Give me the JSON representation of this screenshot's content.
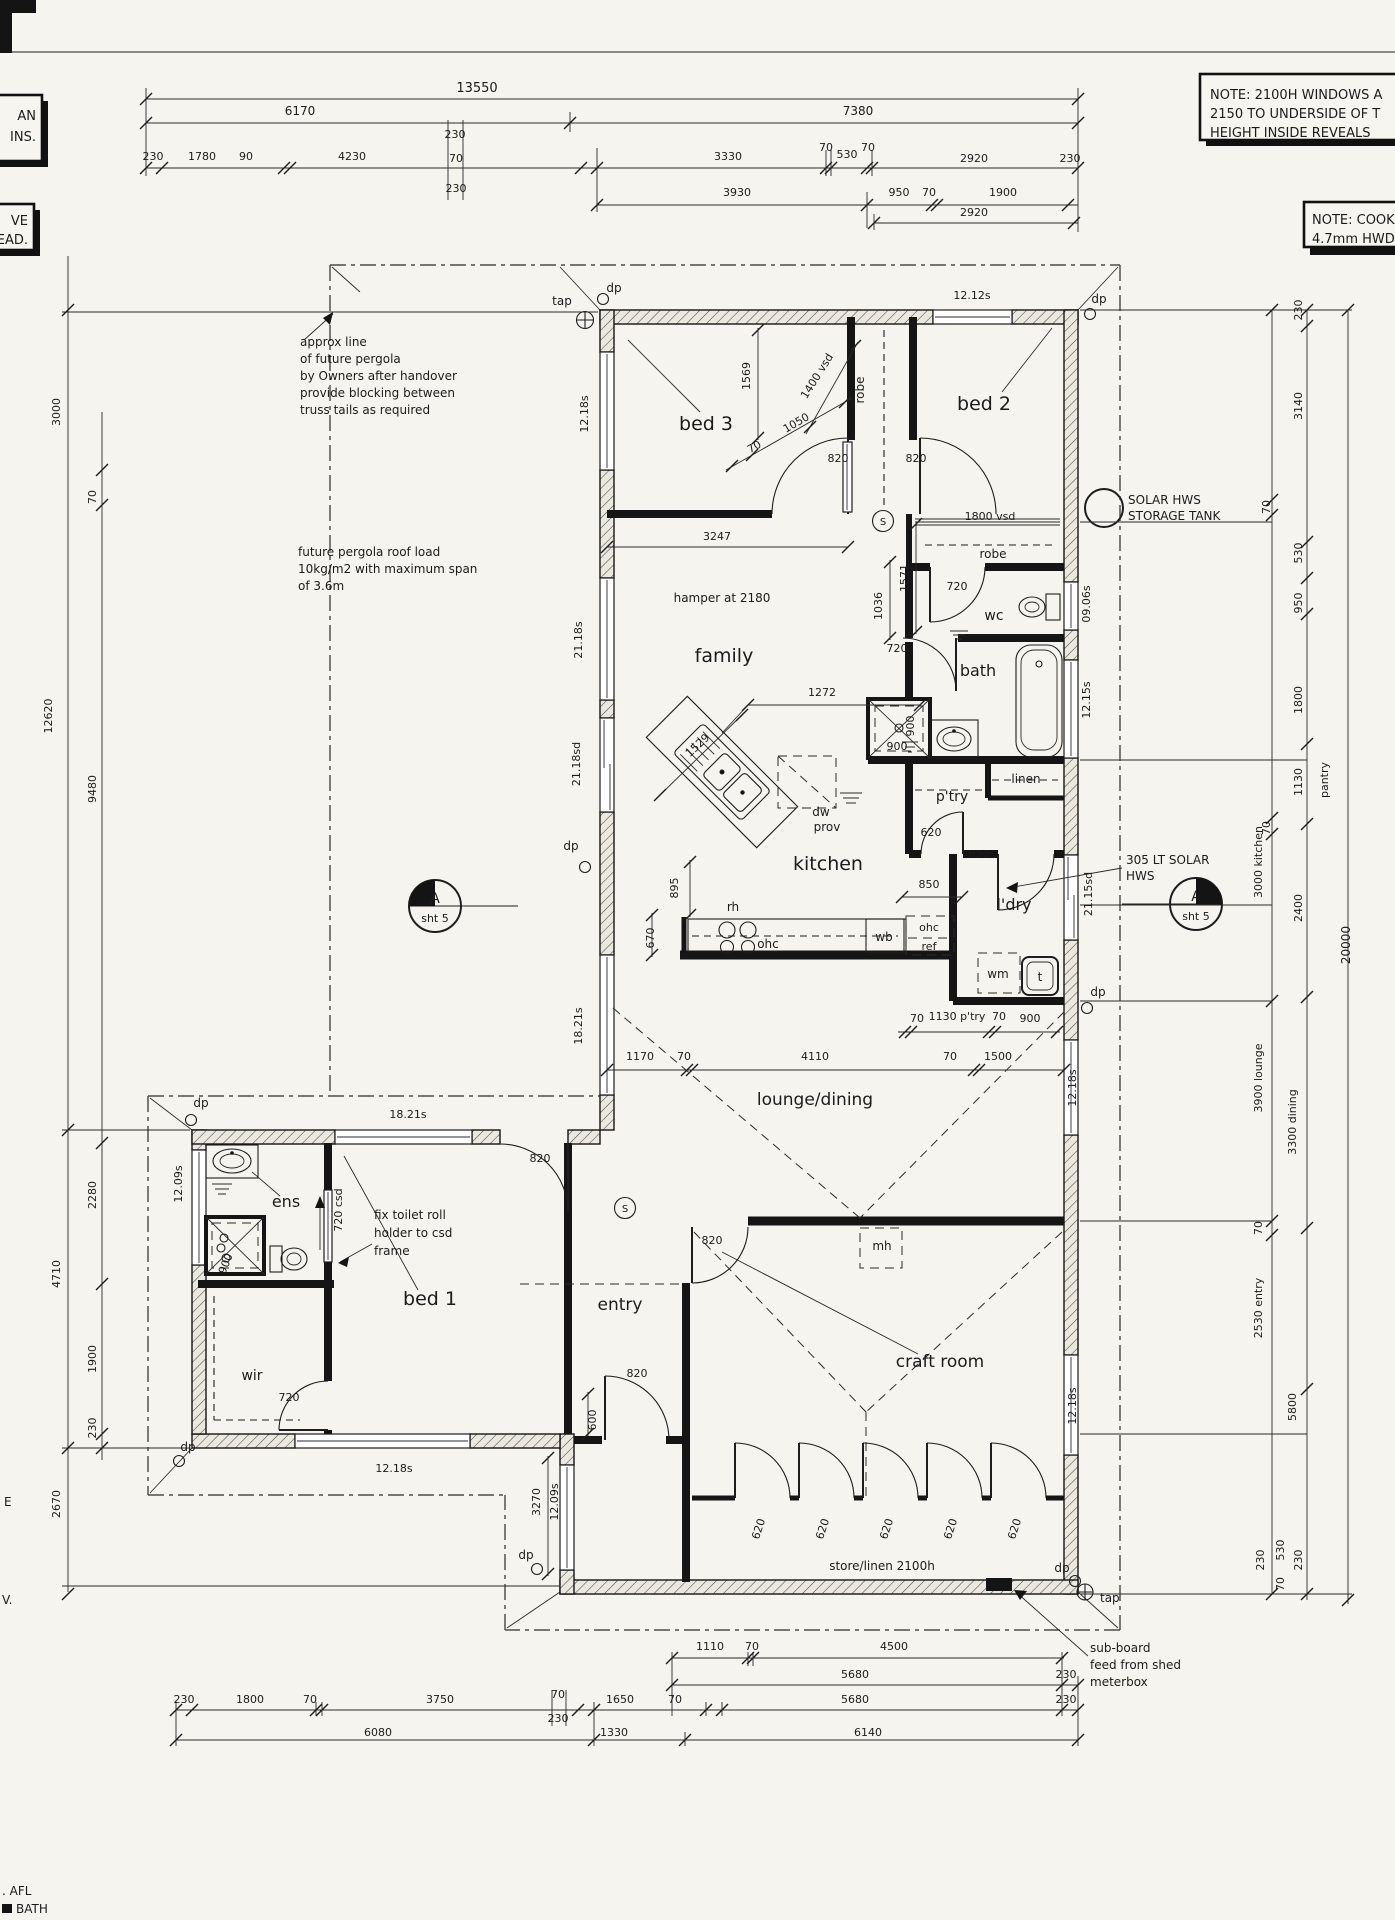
{
  "title": "house floor plan working drawing",
  "colors": {
    "paper": "#f6f4ee",
    "ink": "#1b1b1b",
    "hatch_bg": "#ece9e0"
  },
  "notes": {
    "left_a_line1": "AN",
    "left_a_line2": "INS.",
    "left_b_line1": "VE",
    "left_b_line2": "HEAD.",
    "windows_line1": "NOTE: 2100H WINDOWS A",
    "windows_line2": "2150 TO UNDERSIDE OF T",
    "windows_line3": "HEIGHT INSIDE REVEALS",
    "cook_line1": "NOTE: COOK",
    "cook_line2": "4.7mm HWD",
    "edge_e": "E",
    "edge_v": "V.",
    "edge_afl": ". AFL",
    "edge_bath": "BATH"
  },
  "labels": [
    [
      "13550",
      477,
      92,
      0,
      13
    ],
    [
      "6170",
      300,
      115,
      0,
      12
    ],
    [
      "7380",
      858,
      115,
      0,
      12
    ],
    [
      "230",
      153,
      160
    ],
    [
      "1780",
      202,
      160
    ],
    [
      "90",
      246,
      160
    ],
    [
      "4230",
      352,
      160
    ],
    [
      "230",
      455,
      138
    ],
    [
      "70",
      456,
      162
    ],
    [
      "230",
      456,
      192
    ],
    [
      "3330",
      728,
      160
    ],
    [
      "70",
      826,
      151
    ],
    [
      "530",
      847,
      158
    ],
    [
      "70",
      868,
      151
    ],
    [
      "2920",
      974,
      162
    ],
    [
      "230",
      1070,
      162
    ],
    [
      "3930",
      737,
      196
    ],
    [
      "950",
      899,
      196
    ],
    [
      "70",
      929,
      196
    ],
    [
      "1900",
      1003,
      196
    ],
    [
      "2920",
      974,
      216
    ],
    [
      "3000",
      60,
      412,
      -90
    ],
    [
      "70",
      96,
      497,
      -90
    ],
    [
      "12620",
      52,
      716,
      -90
    ],
    [
      "9480",
      96,
      789,
      -90
    ],
    [
      "2280",
      96,
      1195,
      -90
    ],
    [
      "4710",
      60,
      1274,
      -90
    ],
    [
      "1900",
      96,
      1359,
      -90
    ],
    [
      "230",
      96,
      1428,
      -90
    ],
    [
      "2670",
      60,
      1504,
      -90
    ],
    [
      "230",
      1302,
      310,
      -90
    ],
    [
      "3140",
      1302,
      406,
      -90
    ],
    [
      "70",
      1270,
      507,
      -90
    ],
    [
      "530",
      1302,
      553,
      -90
    ],
    [
      "950",
      1302,
      603,
      -90
    ],
    [
      "1800",
      1302,
      700,
      -90
    ],
    [
      "1130",
      1302,
      782,
      -90
    ],
    [
      "pantry",
      1328,
      780,
      -90
    ],
    [
      "70",
      1270,
      828,
      -90
    ],
    [
      "2400",
      1302,
      908,
      -90
    ],
    [
      "20000",
      1350,
      945,
      -90,
      12
    ],
    [
      "3000 kitchen",
      1262,
      862,
      -90
    ],
    [
      "3900 lounge",
      1262,
      1078,
      -90
    ],
    [
      "3300 dining",
      1296,
      1122,
      -90
    ],
    [
      "70",
      1262,
      1228,
      -90
    ],
    [
      "2530 entry",
      1262,
      1308,
      -90
    ],
    [
      "5800",
      1296,
      1407,
      -90
    ],
    [
      "230",
      1264,
      1560,
      -90
    ],
    [
      "530",
      1284,
      1550,
      -90
    ],
    [
      "70",
      1284,
      1584,
      -90
    ],
    [
      "230",
      1302,
      1560,
      -90
    ],
    [
      "1110",
      710,
      1650
    ],
    [
      "70",
      752,
      1650
    ],
    [
      "4500",
      894,
      1650
    ],
    [
      "5680",
      855,
      1678
    ],
    [
      "230",
      1066,
      1678
    ],
    [
      "230",
      184,
      1703
    ],
    [
      "1800",
      250,
      1703
    ],
    [
      "70",
      310,
      1703
    ],
    [
      "3750",
      440,
      1703
    ],
    [
      "70",
      558,
      1698
    ],
    [
      "230",
      558,
      1722
    ],
    [
      "1650",
      620,
      1703
    ],
    [
      "70",
      675,
      1703
    ],
    [
      "5680",
      855,
      1703
    ],
    [
      "230",
      1066,
      1703
    ],
    [
      "6080",
      378,
      1736
    ],
    [
      "1330",
      614,
      1736
    ],
    [
      "6140",
      868,
      1736
    ],
    [
      "bed 3",
      706,
      430,
      0,
      19
    ],
    [
      "bed 2",
      984,
      410,
      0,
      19
    ],
    [
      "family",
      724,
      662,
      0,
      19
    ],
    [
      "kitchen",
      828,
      870,
      0,
      19
    ],
    [
      "lounge/dining",
      815,
      1105,
      0,
      17
    ],
    [
      "bed 1",
      430,
      1305,
      0,
      19
    ],
    [
      "entry",
      620,
      1310,
      0,
      17
    ],
    [
      "craft room",
      940,
      1367,
      0,
      17
    ],
    [
      "ens",
      286,
      1207,
      0,
      16
    ],
    [
      "wir",
      252,
      1380,
      0,
      14
    ],
    [
      "wc",
      994,
      620,
      0,
      14
    ],
    [
      "bath",
      978,
      676,
      0,
      16
    ],
    [
      "p'try",
      952,
      801,
      0,
      14
    ],
    [
      "l'dry",
      1014,
      910,
      0,
      16
    ],
    [
      "linen",
      1026,
      783,
      0,
      12
    ],
    [
      "robe",
      864,
      390,
      -90,
      12
    ],
    [
      "robe",
      993,
      558,
      0,
      12
    ],
    [
      "store/linen 2100h",
      882,
      1570,
      0,
      12
    ],
    [
      "mh",
      882,
      1250,
      0,
      12
    ],
    [
      "12.18s",
      588,
      414,
      -90
    ],
    [
      "21.18s",
      582,
      640,
      -90
    ],
    [
      "21.18sd",
      580,
      764,
      -90
    ],
    [
      "18.21s",
      582,
      1026,
      -90
    ],
    [
      "12.12s",
      972,
      299
    ],
    [
      "09.06s",
      1090,
      604,
      -90
    ],
    [
      "12.15s",
      1090,
      700,
      -90
    ],
    [
      "21.15sd",
      1092,
      894,
      -90
    ],
    [
      "12.18s",
      1076,
      1088,
      -90
    ],
    [
      "12.18s",
      1076,
      1406,
      -90
    ],
    [
      "18.21s",
      408,
      1118
    ],
    [
      "12.09s",
      182,
      1184,
      -90
    ],
    [
      "12.18s",
      394,
      1472
    ],
    [
      "3270",
      540,
      1502,
      -90
    ],
    [
      "12.09s",
      558,
      1502,
      -90
    ],
    [
      "820",
      838,
      462
    ],
    [
      "820",
      916,
      462
    ],
    [
      "1400 vsd",
      820,
      378,
      -58
    ],
    [
      "1050",
      798,
      426,
      -30
    ],
    [
      "70",
      756,
      450,
      -30
    ],
    [
      "1569",
      750,
      376,
      -90
    ],
    [
      "3247",
      717,
      540
    ],
    [
      "1800 vsd",
      990,
      520
    ],
    [
      "720",
      957,
      590
    ],
    [
      "1571",
      908,
      578,
      -90
    ],
    [
      "1036",
      882,
      606,
      -90
    ],
    [
      "720",
      897,
      652
    ],
    [
      "1272",
      822,
      696
    ],
    [
      "hamper at 2180",
      722,
      602,
      0,
      12
    ],
    [
      "900",
      914,
      726,
      -90
    ],
    [
      "900",
      897,
      750
    ],
    [
      "620",
      931,
      836
    ],
    [
      "850",
      929,
      888
    ],
    [
      "820",
      979,
      858
    ],
    [
      "1529",
      700,
      748,
      -43
    ],
    [
      "895",
      678,
      888,
      -90
    ],
    [
      "670",
      654,
      938,
      -90
    ],
    [
      "rh",
      733,
      911,
      0,
      12
    ],
    [
      "ohc",
      768,
      948,
      0,
      12
    ],
    [
      "wb",
      884,
      941,
      0,
      12
    ],
    [
      "ohc",
      929,
      931,
      0,
      11
    ],
    [
      "ref",
      929,
      950,
      0,
      11
    ],
    [
      "dw",
      821,
      816,
      0,
      12
    ],
    [
      "prov",
      827,
      831,
      0,
      12
    ],
    [
      "wm",
      998,
      978,
      0,
      12
    ],
    [
      "t",
      1040,
      981,
      0,
      12
    ],
    [
      "70",
      917,
      1022
    ],
    [
      "1130 p'try",
      957,
      1020
    ],
    [
      "70",
      999,
      1020
    ],
    [
      "900",
      1030,
      1022
    ],
    [
      "1170",
      640,
      1060
    ],
    [
      "70",
      684,
      1060
    ],
    [
      "4110",
      815,
      1060
    ],
    [
      "70",
      950,
      1060
    ],
    [
      "1500",
      998,
      1060
    ],
    [
      "820",
      540,
      1162
    ],
    [
      "820",
      712,
      1244
    ],
    [
      "820",
      637,
      1377
    ],
    [
      "600",
      596,
      1420,
      -90
    ],
    [
      "720 csd",
      342,
      1210,
      -90
    ],
    [
      "720",
      289,
      1401
    ],
    [
      "900",
      229,
      1265,
      -68
    ],
    [
      "620",
      762,
      1530,
      -72
    ],
    [
      "620",
      826,
      1530,
      -72
    ],
    [
      "620",
      890,
      1530,
      -72
    ],
    [
      "620",
      954,
      1530,
      -72
    ],
    [
      "620",
      1018,
      1530,
      -72
    ],
    [
      "approx line",
      300,
      346,
      0,
      12,
      "s"
    ],
    [
      "of future pergola",
      300,
      363,
      0,
      12,
      "s"
    ],
    [
      "by Owners after handover",
      300,
      380,
      0,
      12,
      "s"
    ],
    [
      "provide blocking between",
      300,
      397,
      0,
      12,
      "s"
    ],
    [
      "truss tails as required",
      300,
      414,
      0,
      12,
      "s"
    ],
    [
      "future pergola roof load",
      298,
      556,
      0,
      12,
      "s"
    ],
    [
      "10kg/m2 with maximum span",
      298,
      573,
      0,
      12,
      "s"
    ],
    [
      "of 3.6m",
      298,
      590,
      0,
      12,
      "s"
    ],
    [
      "SOLAR HWS",
      1128,
      504,
      0,
      12,
      "s"
    ],
    [
      "STORAGE TANK",
      1128,
      520,
      0,
      12,
      "s"
    ],
    [
      "305 LT SOLAR",
      1126,
      864,
      0,
      12,
      "s"
    ],
    [
      "HWS",
      1126,
      880,
      0,
      12,
      "s"
    ],
    [
      "fix toilet roll",
      374,
      1219,
      0,
      12,
      "s"
    ],
    [
      "holder to csd",
      374,
      1237,
      0,
      12,
      "s"
    ],
    [
      "frame",
      374,
      1255,
      0,
      12,
      "s"
    ],
    [
      "sub-board",
      1090,
      1652,
      0,
      12,
      "s"
    ],
    [
      "feed from shed",
      1090,
      1669,
      0,
      12,
      "s"
    ],
    [
      "meterbox",
      1090,
      1686,
      0,
      12,
      "s"
    ],
    [
      "dp",
      614,
      292,
      0,
      12
    ],
    [
      "tap",
      562,
      305,
      0,
      12
    ],
    [
      "dp",
      1099,
      303,
      0,
      12
    ],
    [
      "dp",
      571,
      850,
      0,
      12
    ],
    [
      "dp",
      1098,
      996,
      0,
      12
    ],
    [
      "dp",
      201,
      1107,
      0,
      12
    ],
    [
      "dp",
      188,
      1451,
      0,
      12
    ],
    [
      "dp",
      526,
      1559,
      0,
      12
    ],
    [
      "dp",
      1062,
      1572,
      0,
      12
    ],
    [
      "tap",
      1100,
      1602,
      0,
      12,
      "s"
    ],
    [
      "A",
      435,
      903,
      0,
      14
    ],
    [
      "sht 5",
      435,
      922,
      0,
      11
    ],
    [
      "A",
      1196,
      901,
      0,
      14
    ],
    [
      "sht 5",
      1196,
      920,
      0,
      11
    ],
    [
      "S",
      883,
      525,
      0,
      10
    ],
    [
      "S",
      625,
      1212,
      0,
      10
    ]
  ]
}
